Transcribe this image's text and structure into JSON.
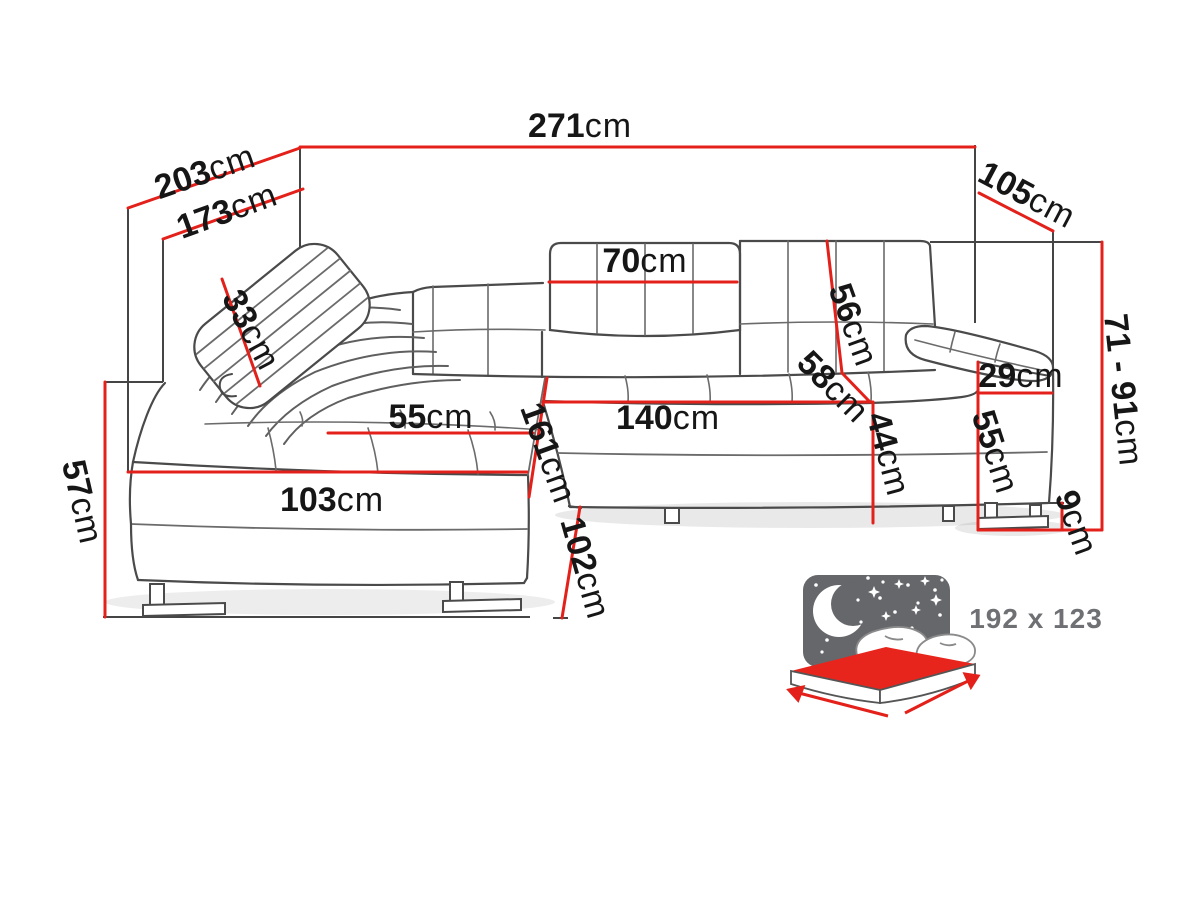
{
  "diagram": {
    "type": "corner-sofa-dimension-diagram",
    "unit": "cm",
    "colors": {
      "dimension_line": "#e3211a",
      "outline": "#4a4a4a",
      "text": "#161616",
      "bed_icon_background": "#65676b",
      "bed_mattress": "#e8251d",
      "bed_text": "#6f7073"
    },
    "dimensions": [
      {
        "name": "total-width",
        "label": "271",
        "unit": "cm"
      },
      {
        "name": "total-depth-outer",
        "label": "203",
        "unit": "cm"
      },
      {
        "name": "total-depth-inner",
        "label": "173",
        "unit": "cm"
      },
      {
        "name": "side-depth",
        "label": "105",
        "unit": "cm"
      },
      {
        "name": "height-range",
        "label": "71 - 91",
        "unit": "cm"
      },
      {
        "name": "headrest-pillow",
        "label": "33",
        "unit": "cm"
      },
      {
        "name": "backrest-cushion-width",
        "label": "70",
        "unit": "cm"
      },
      {
        "name": "backrest-height",
        "label": "56",
        "unit": "cm"
      },
      {
        "name": "seat-depth",
        "label": "58",
        "unit": "cm"
      },
      {
        "name": "chaise-cushion-width",
        "label": "55",
        "unit": "cm"
      },
      {
        "name": "seat-width",
        "label": "140",
        "unit": "cm"
      },
      {
        "name": "chaise-length",
        "label": "161",
        "unit": "cm"
      },
      {
        "name": "seat-height",
        "label": "44",
        "unit": "cm"
      },
      {
        "name": "armrest-top-width",
        "label": "29",
        "unit": "cm"
      },
      {
        "name": "armrest-height",
        "label": "55",
        "unit": "cm"
      },
      {
        "name": "chaise-front-width",
        "label": "103",
        "unit": "cm"
      },
      {
        "name": "chaise-height",
        "label": "57",
        "unit": "cm"
      },
      {
        "name": "sofa-depth",
        "label": "102",
        "unit": "cm"
      },
      {
        "name": "leg-height",
        "label": "9",
        "unit": "cm"
      }
    ],
    "sleeping_area": {
      "label": "192 x 123"
    }
  }
}
